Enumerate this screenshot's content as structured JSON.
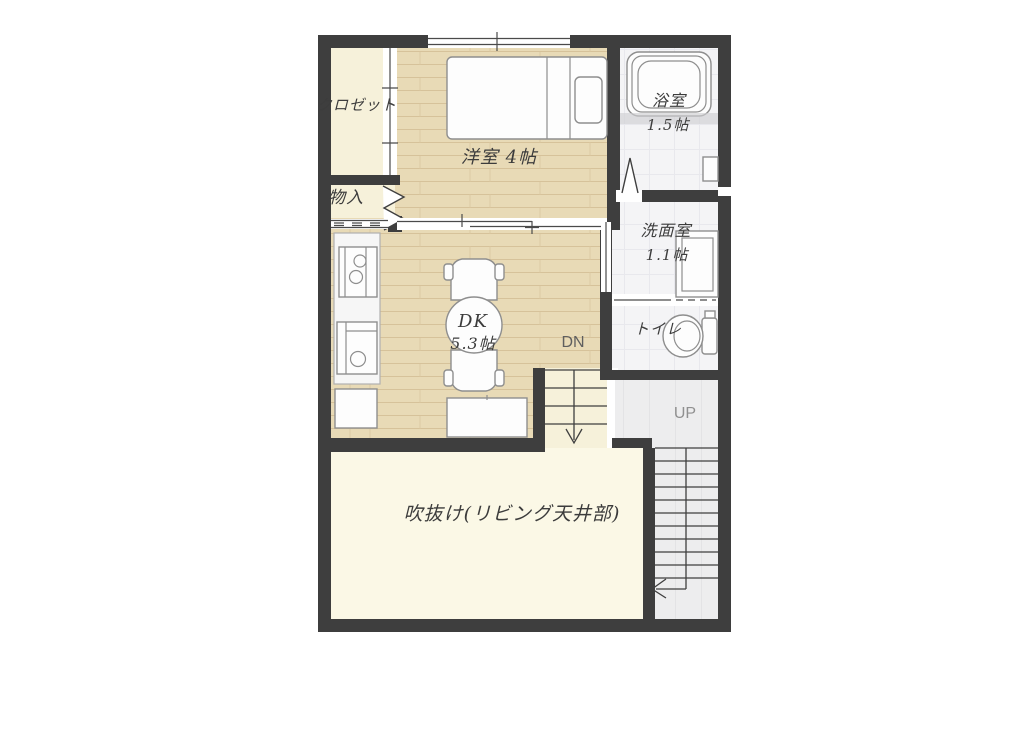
{
  "plan": {
    "title": "2F floor plan",
    "rooms": {
      "closet": {
        "label": "クロゼット"
      },
      "storage": {
        "label": "物入"
      },
      "western_room": {
        "label": "洋室 4帖"
      },
      "bathroom": {
        "label": "浴室",
        "size": "1.5帖"
      },
      "washroom": {
        "label": "洗面室",
        "size": "1.1帖"
      },
      "toilet": {
        "label": "トイレ"
      },
      "dining_kitchen": {
        "label": "DK",
        "size": "5.3帖"
      },
      "void_space": {
        "label": "吹抜け(リビング天井部)"
      }
    },
    "stairs": {
      "down_label": "DN",
      "up_label": "UP"
    },
    "fixtures": [
      "single-bed",
      "bathtub",
      "vanity-basin",
      "toilet-bowl",
      "kitchen-stove",
      "kitchen-sink",
      "base-cabinet",
      "round-dining-table",
      "chair",
      "chair",
      "sideboard"
    ],
    "colors": {
      "wall": "#3e3e3e",
      "wood_floor": "#e8dab6",
      "cream_floor": "#f6f1da",
      "void_floor": "#fbf8e6",
      "tile_floor": "#f4f4f6",
      "stair_floor": "#ededee",
      "fixture_outline": "#8e8e8e",
      "label_text": "#3c3c3c",
      "stair_label": "#8a8a8a"
    }
  }
}
